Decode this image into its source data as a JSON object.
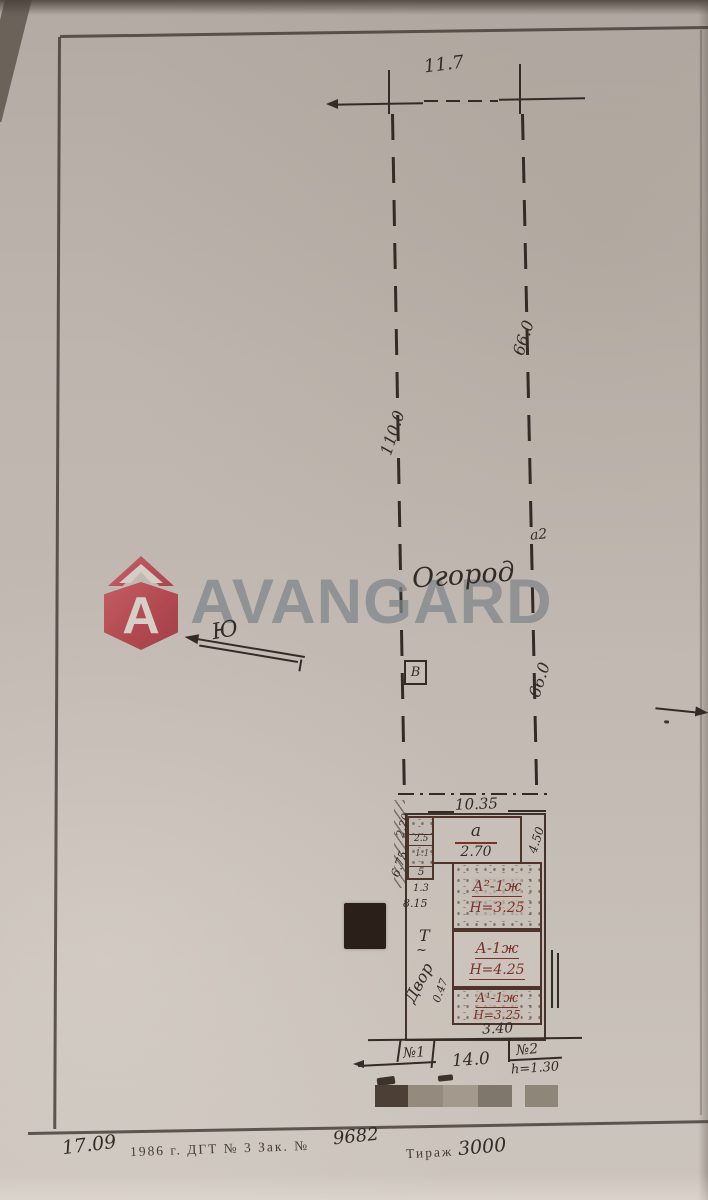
{
  "colors": {
    "paper": "#bfb7af",
    "ink": "#332c26",
    "red_ink": "#7c3128",
    "brand_red": "#c4515a",
    "brand_gray": "#7e858b",
    "censor_dark": "#4c4036",
    "censor_g1": "#948b7e",
    "censor_g2": "#a39a8d",
    "censor_g3": "#7f776b",
    "censor_g4": "#8e8779",
    "censor_black": "#2a2019"
  },
  "watermark": {
    "brand": "AVANGARD",
    "monogram": "А"
  },
  "survey": {
    "top_width": "11.7",
    "upper_side": "66.0",
    "middle_length": "110.0",
    "lower_side": "66.0",
    "garden": "Огород",
    "point_a2": "а2",
    "point_b": "В",
    "south": "Ю"
  },
  "plot": {
    "frontage": "10.35",
    "entry_letter": "а",
    "entry_area": "2.70",
    "right_offset": "4.50",
    "left_offset_upper": "2.20",
    "left_offset": "6.75",
    "cells": {
      "c1": "2.5",
      "c2": "1.1",
      "c3": "5",
      "c4": "1.3"
    },
    "left_length": "8.15",
    "t_mark": "Т",
    "diag_offset": "0.47",
    "yard": "Двор",
    "house_main": "А²-1ж",
    "house_main_h": "Н=3.25",
    "house_mid": "А-1ж",
    "house_mid_h": "Н=4.25",
    "house_low": "А¹-1ж",
    "house_low_h": "Н=3.25",
    "rear_width": "3.40",
    "gate_1": "№1",
    "span": "14.0",
    "gate_2": "№2",
    "gate_2_h": "h=1.30"
  },
  "footer": {
    "date": "17.09",
    "imprint": "1986 г.  ДГТ  № 3  Зак. №",
    "order_no": "9682",
    "print_run_label": "Тираж",
    "print_run": "3000"
  }
}
